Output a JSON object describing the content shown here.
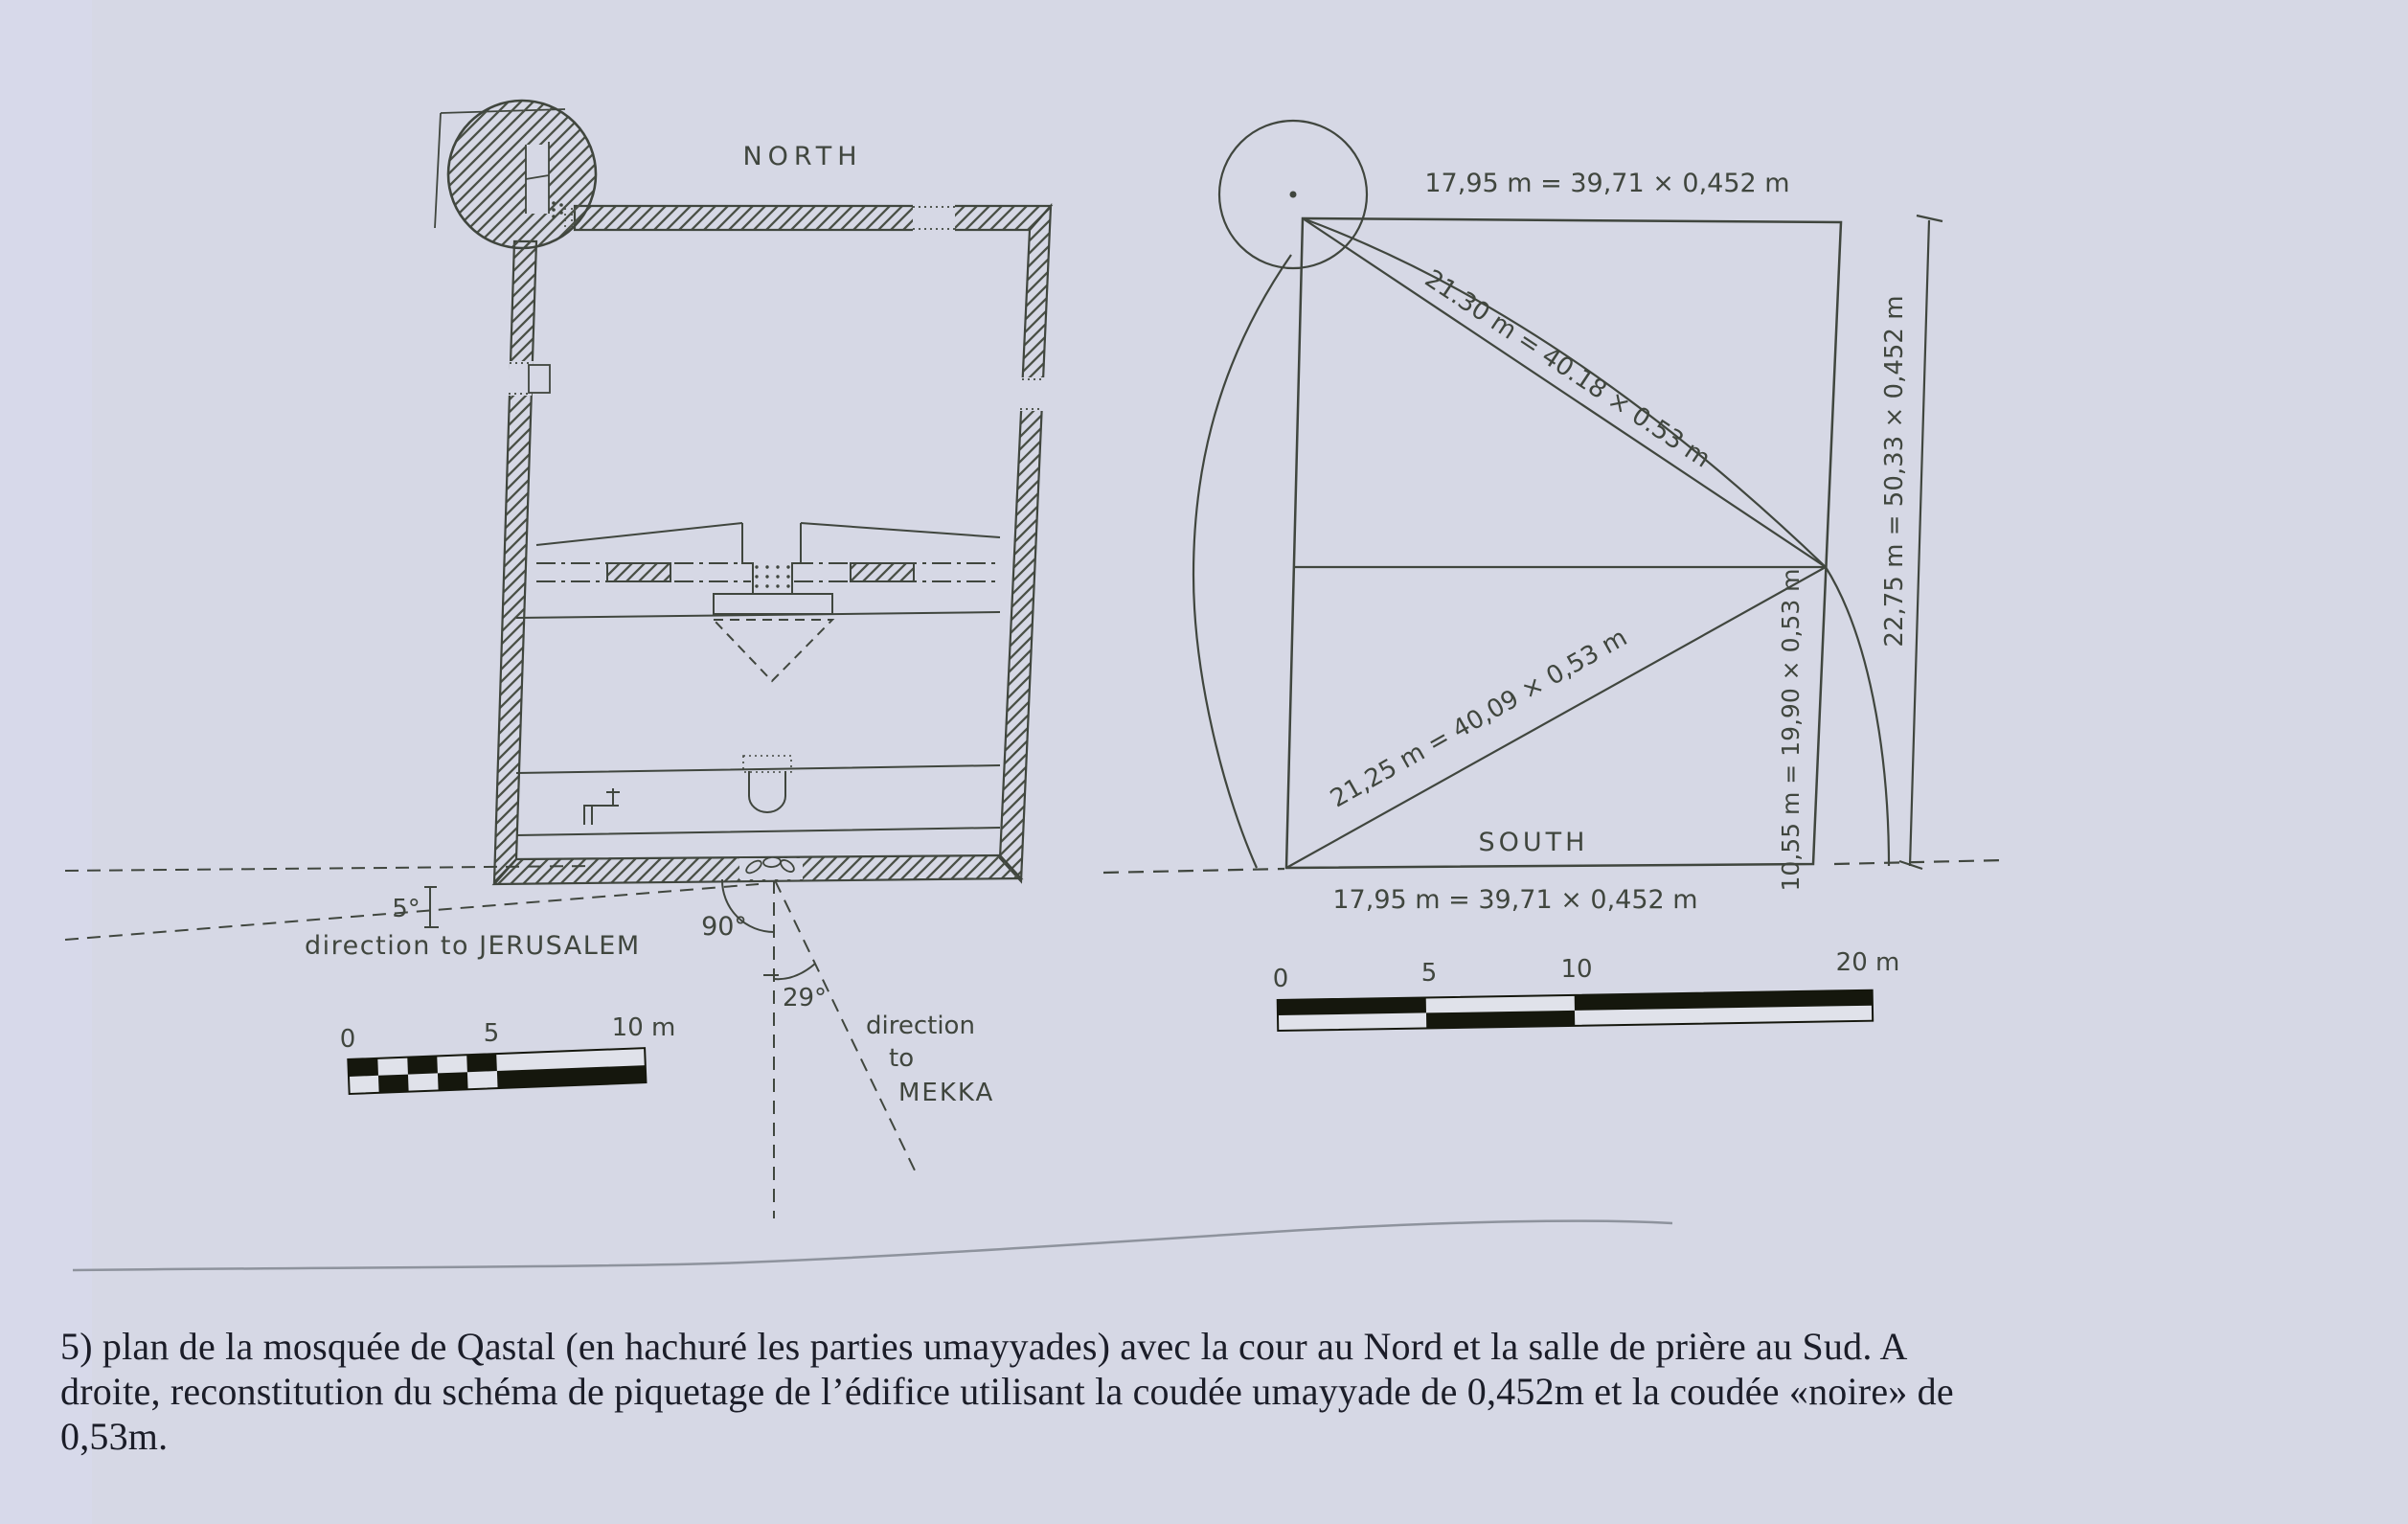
{
  "document": {
    "colors": {
      "paper": "#d6d8e5",
      "ink": "#40463e",
      "scalebar_black": "#15170d",
      "caption_ink": "#1b1d28",
      "page_edge": "#8e939d"
    },
    "plan": {
      "north_label": "NORTH",
      "wall_angle": "5°",
      "jerusalem_label": "direction to JERUSALEM",
      "perpendicular_angle": "90°",
      "qibla_angle": "29°",
      "mekka_label_line1": "direction",
      "mekka_label_line2": "to",
      "mekka_label_line3": "MEKKA",
      "scalebar": {
        "tick0": "0",
        "tick5": "5",
        "tick10": "10 m"
      }
    },
    "scheme": {
      "top_dimension": "17,95 m = 39,71 × 0,452 m",
      "upper_diagonal_dimension": "21.30 m = 40.18 × 0.53 m",
      "lower_diagonal_dimension": "21,25 m = 40,09 × 0,53 m",
      "right_segment_dimension": "10,55 m = 19,90 × 0,53 m",
      "right_overall_dimension": "22,75 m = 50,33 × 0,452 m",
      "south_label": "SOUTH",
      "bottom_dimension": "17,95 m = 39,71 × 0,452 m",
      "scalebar": {
        "tick0": "0",
        "tick5": "5",
        "tick10": "10",
        "tick20": "20 m"
      }
    },
    "caption": {
      "line1": "5) plan de la mosquée de Qastal (en hachuré les parties umayyades) avec la cour au Nord et la salle de prière au Sud. A",
      "line2": "droite, reconstitution du schéma de piquetage de l’édifice utilisant la coudée umayyade de 0,452m et la coudée «noire» de",
      "line3": "0,53m."
    }
  }
}
